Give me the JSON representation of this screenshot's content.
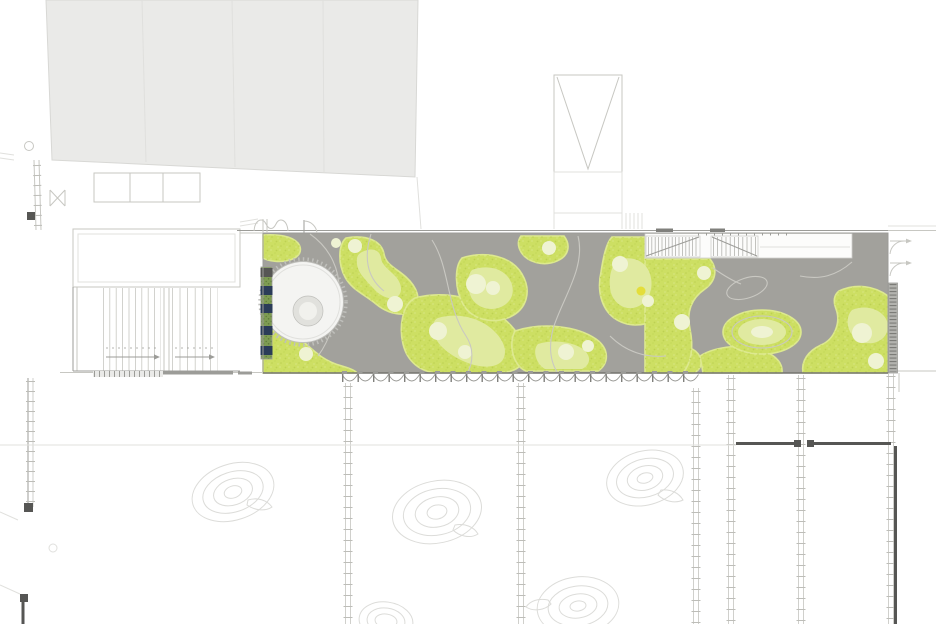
{
  "title": "",
  "drawing": {
    "kind": "roof-garden-site-plan",
    "visible_text": [],
    "components": {
      "neighbor_building": "large light-gray building volume, top-left, four bays",
      "roof_strip": "long gray roof terrace with organic green landscape islands",
      "circular_pavilion": "white drum building with inner ring, left end of strip",
      "green_wall_strip": "vertical planted strip with navy panels on pavilion west edge",
      "stair_band": "white band with two hatched stair runs, top of strip",
      "scallop_edge": "scalloped awning / rack band along strip south edge",
      "column_ladders": "six laddered column/mullion lines running to bottom",
      "tree_contours": "five faint concentric landform/tree contours with leaf",
      "tower": "rectangular shaft with V ramp symbol, top center",
      "dark_walls": "dark wall segments with door gap, lower right",
      "side_hatch": "hatched stair band on right edge of strip",
      "door_swings": "two door-swing symbols right of strip"
    }
  },
  "counts": {
    "neighbor_bays": 4,
    "navy_panels": 5,
    "tree_contours": 5,
    "column_ladders": 6,
    "stair_runs": 2
  },
  "colors": {
    "canvas_bg": "#ffffff",
    "neighbor_fill": "#eaeae8",
    "neighbor_line": "#d8d8d5",
    "line_faint": "#e0e0dd",
    "line_light": "#c7c7c2",
    "line_mid": "#9c9c98",
    "line_dark": "#74746f",
    "roof_gray": "#a2a19c",
    "path_line": "#c9c8c2",
    "green_base": "#cddf63",
    "green_fringe": "#dde98f",
    "green_speck": "#b9ce4e",
    "green_light": "#e0eaa0",
    "green_pale": "#eff3d3",
    "green_yellow": "#e4de3a",
    "pavilion_fill": "#f4f4f2",
    "pavilion_ring": "#e1e1dd",
    "pavilion_core": "#f1f1ed",
    "pavilion_line": "#bfbfbb",
    "greenwall_green": "#7e9c53",
    "greenwall_speck": "#5d7a3a",
    "navy": "#2b3c58",
    "band_fill": "#fcfcfb",
    "band_line": "#cfcfcc",
    "scallop_line": "#9b9b97",
    "post_dark": "#80807c",
    "wall_dark": "#565654",
    "tree_line": "#dcdcd9",
    "hatch_fill": "#b3b3af",
    "hatch_rung": "#7c7c78",
    "ladder_rail": "#c4c4c0",
    "ladder_rung": "#bdbdb8"
  }
}
